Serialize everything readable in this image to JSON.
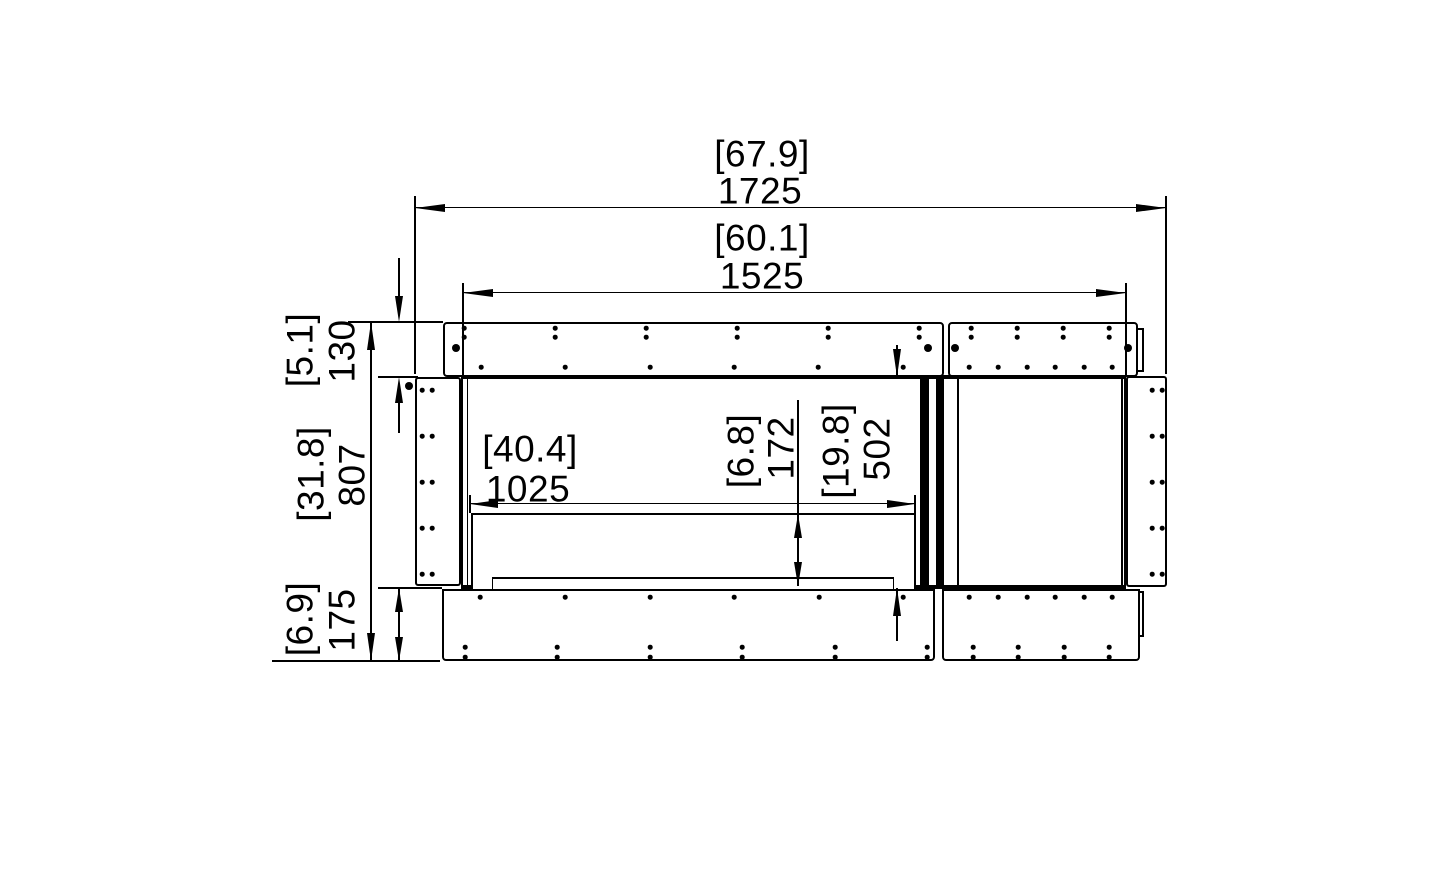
{
  "dimensions": {
    "overall_width": {
      "inches": "[67.9]",
      "mm": "1725"
    },
    "fascia_width": {
      "inches": "[60.1]",
      "mm": "1525"
    },
    "flange_height": {
      "inches": "[5.1]",
      "mm": "130"
    },
    "overall_height": {
      "inches": "[31.8]",
      "mm": "807"
    },
    "base_height": {
      "inches": "[6.9]",
      "mm": "175"
    },
    "burner_width": {
      "inches": "[40.4]",
      "mm": "1025"
    },
    "burner_inset": {
      "inches": "[6.8]",
      "mm": "172"
    },
    "opening_height": {
      "inches": "[19.8]",
      "mm": "502"
    }
  }
}
